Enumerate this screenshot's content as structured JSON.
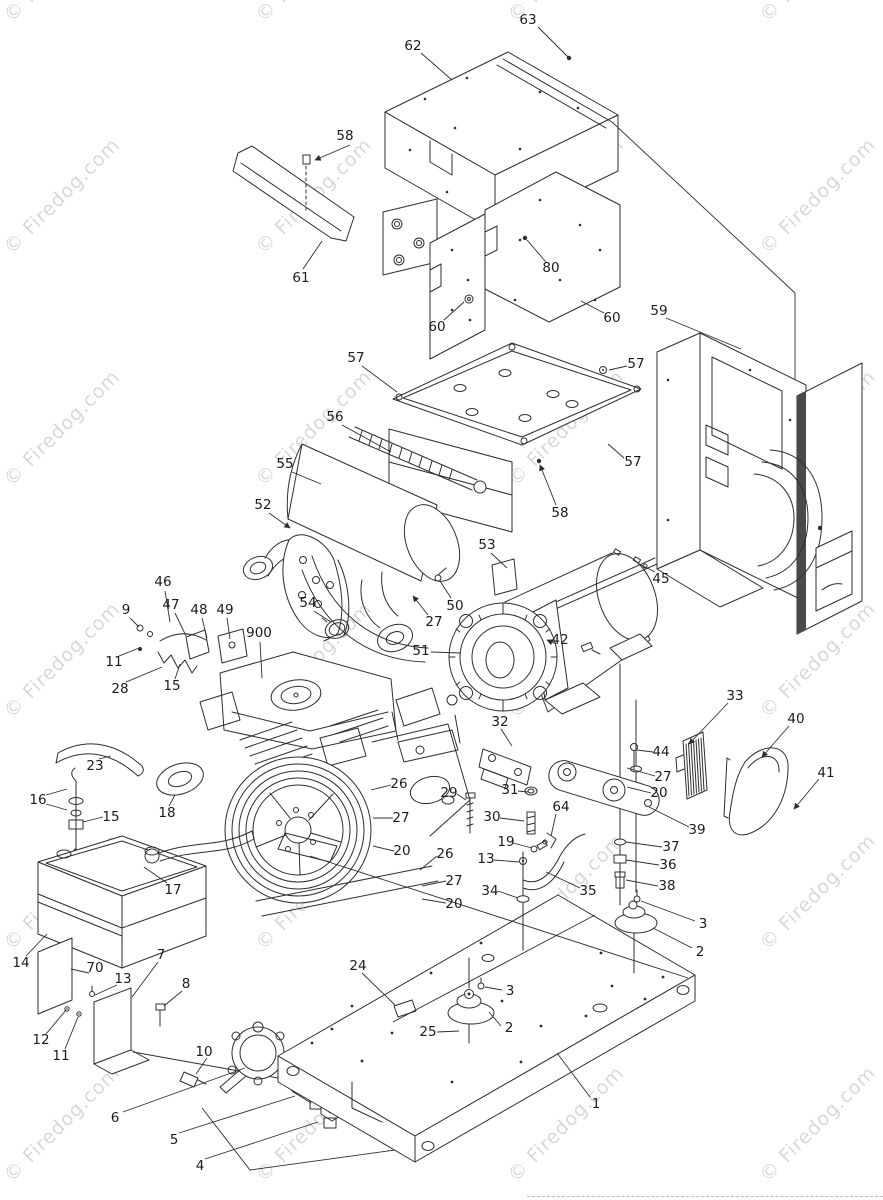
{
  "watermark": {
    "text": "© Firedog.com",
    "color": "#d8d8d8",
    "positions": [
      [
        62,
        -36
      ],
      [
        314,
        -36
      ],
      [
        566,
        -36
      ],
      [
        818,
        -36
      ],
      [
        62,
        196
      ],
      [
        314,
        196
      ],
      [
        566,
        196
      ],
      [
        818,
        196
      ],
      [
        62,
        428
      ],
      [
        314,
        428
      ],
      [
        566,
        428
      ],
      [
        818,
        428
      ],
      [
        62,
        660
      ],
      [
        314,
        660
      ],
      [
        566,
        660
      ],
      [
        818,
        660
      ],
      [
        62,
        892
      ],
      [
        314,
        892
      ],
      [
        566,
        892
      ],
      [
        818,
        892
      ],
      [
        62,
        1124
      ],
      [
        314,
        1124
      ],
      [
        566,
        1124
      ],
      [
        818,
        1124
      ]
    ]
  },
  "divider": {
    "color": "#d9a8cc",
    "x": 527,
    "y": 1196,
    "width": 356
  },
  "callouts": [
    {
      "n": "63",
      "x": 528,
      "y": 20
    },
    {
      "n": "62",
      "x": 413,
      "y": 46
    },
    {
      "n": "58",
      "x": 345,
      "y": 136
    },
    {
      "n": "61",
      "x": 301,
      "y": 278
    },
    {
      "n": "80",
      "x": 551,
      "y": 268
    },
    {
      "n": "60",
      "x": 437,
      "y": 327
    },
    {
      "n": "60",
      "x": 612,
      "y": 318
    },
    {
      "n": "59",
      "x": 659,
      "y": 311
    },
    {
      "n": "57",
      "x": 356,
      "y": 358
    },
    {
      "n": "57",
      "x": 636,
      "y": 364
    },
    {
      "n": "56",
      "x": 335,
      "y": 417
    },
    {
      "n": "55",
      "x": 285,
      "y": 464
    },
    {
      "n": "57",
      "x": 633,
      "y": 462
    },
    {
      "n": "52",
      "x": 263,
      "y": 505
    },
    {
      "n": "58",
      "x": 560,
      "y": 513
    },
    {
      "n": "53",
      "x": 487,
      "y": 545
    },
    {
      "n": "45",
      "x": 661,
      "y": 579
    },
    {
      "n": "46",
      "x": 163,
      "y": 582
    },
    {
      "n": "9",
      "x": 126,
      "y": 610
    },
    {
      "n": "47",
      "x": 171,
      "y": 605
    },
    {
      "n": "48",
      "x": 199,
      "y": 610
    },
    {
      "n": "49",
      "x": 225,
      "y": 610
    },
    {
      "n": "54",
      "x": 308,
      "y": 603
    },
    {
      "n": "50",
      "x": 455,
      "y": 606
    },
    {
      "n": "27",
      "x": 434,
      "y": 622
    },
    {
      "n": "900",
      "x": 259,
      "y": 633
    },
    {
      "n": "42",
      "x": 560,
      "y": 640
    },
    {
      "n": "51",
      "x": 421,
      "y": 651
    },
    {
      "n": "11",
      "x": 114,
      "y": 662
    },
    {
      "n": "15",
      "x": 172,
      "y": 686
    },
    {
      "n": "28",
      "x": 120,
      "y": 689
    },
    {
      "n": "33",
      "x": 735,
      "y": 696
    },
    {
      "n": "40",
      "x": 796,
      "y": 719
    },
    {
      "n": "32",
      "x": 500,
      "y": 722
    },
    {
      "n": "23",
      "x": 95,
      "y": 766
    },
    {
      "n": "44",
      "x": 661,
      "y": 752
    },
    {
      "n": "41",
      "x": 826,
      "y": 773
    },
    {
      "n": "27",
      "x": 663,
      "y": 777
    },
    {
      "n": "26",
      "x": 399,
      "y": 784
    },
    {
      "n": "20",
      "x": 659,
      "y": 793
    },
    {
      "n": "29",
      "x": 449,
      "y": 793
    },
    {
      "n": "31",
      "x": 510,
      "y": 790
    },
    {
      "n": "16",
      "x": 38,
      "y": 800
    },
    {
      "n": "30",
      "x": 492,
      "y": 817
    },
    {
      "n": "27",
      "x": 401,
      "y": 818
    },
    {
      "n": "64",
      "x": 561,
      "y": 807
    },
    {
      "n": "15",
      "x": 111,
      "y": 817
    },
    {
      "n": "18",
      "x": 167,
      "y": 813
    },
    {
      "n": "39",
      "x": 697,
      "y": 830
    },
    {
      "n": "19",
      "x": 506,
      "y": 842
    },
    {
      "n": "37",
      "x": 671,
      "y": 847
    },
    {
      "n": "20",
      "x": 402,
      "y": 851
    },
    {
      "n": "26",
      "x": 445,
      "y": 854
    },
    {
      "n": "13",
      "x": 486,
      "y": 859
    },
    {
      "n": "36",
      "x": 668,
      "y": 865
    },
    {
      "n": "27",
      "x": 454,
      "y": 881
    },
    {
      "n": "34",
      "x": 490,
      "y": 891
    },
    {
      "n": "35",
      "x": 588,
      "y": 891
    },
    {
      "n": "38",
      "x": 667,
      "y": 886
    },
    {
      "n": "17",
      "x": 173,
      "y": 890
    },
    {
      "n": "20",
      "x": 454,
      "y": 904
    },
    {
      "n": "3",
      "x": 703,
      "y": 924
    },
    {
      "n": "2",
      "x": 700,
      "y": 952
    },
    {
      "n": "14",
      "x": 21,
      "y": 963
    },
    {
      "n": "7",
      "x": 161,
      "y": 955
    },
    {
      "n": "24",
      "x": 358,
      "y": 966
    },
    {
      "n": "70",
      "x": 95,
      "y": 968
    },
    {
      "n": "13",
      "x": 123,
      "y": 979
    },
    {
      "n": "8",
      "x": 186,
      "y": 984
    },
    {
      "n": "3",
      "x": 510,
      "y": 991
    },
    {
      "n": "2",
      "x": 509,
      "y": 1028
    },
    {
      "n": "25",
      "x": 428,
      "y": 1032
    },
    {
      "n": "12",
      "x": 41,
      "y": 1040
    },
    {
      "n": "11",
      "x": 61,
      "y": 1056
    },
    {
      "n": "10",
      "x": 204,
      "y": 1052
    },
    {
      "n": "1",
      "x": 596,
      "y": 1104
    },
    {
      "n": "6",
      "x": 115,
      "y": 1118
    },
    {
      "n": "5",
      "x": 174,
      "y": 1140
    },
    {
      "n": "4",
      "x": 200,
      "y": 1166
    }
  ]
}
